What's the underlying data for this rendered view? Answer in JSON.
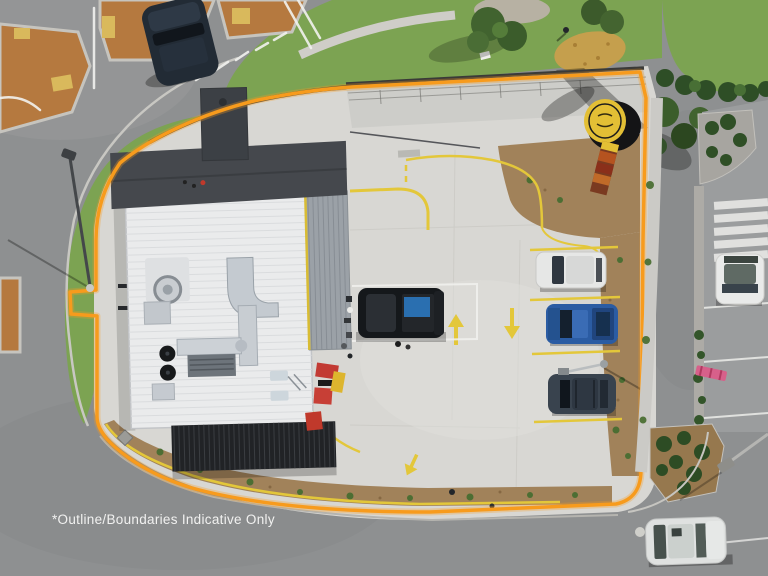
{
  "caption": {
    "text": "*Outline/Boundaries Indicative Only"
  },
  "scene": {
    "type": "aerial-drone-photo",
    "subject": "Drive-through restaurant property viewed from directly above, outlined with an indicative site boundary",
    "overlay": {
      "kind": "site-boundary-outline",
      "color": "#F79B1D",
      "note": "indicative only"
    },
    "site": {
      "building": {
        "main_roof": "white metal roof with rooftop HVAC ducts, fans and vents",
        "entry_feature": "dark charcoal awning band and tower",
        "side_wing": "grey corrugated roof with yellow trim",
        "rear_canopy": "dark slatted pergola over outdoor area",
        "outdoor_dining": "red and yellow umbrellas along east wall"
      },
      "pavement_markings": [
        "yellow drive-through lane lines",
        "yellow hatched keep-clear zones",
        "yellow directional arrows",
        "white parking bay lines",
        "blue accessible-parking square"
      ],
      "landscaping": [
        "mulched garden beds with young plants along south and east edges",
        "grass verge along west and north edges"
      ],
      "signage": {
        "pylon_sign": "round yellow disc sign with black drum edge on totem with orange menu panels"
      }
    },
    "vehicles": [
      {
        "name": "pickup-truck-at-building",
        "color": "#15181B",
        "detail": "dark ute with blue tarp load parked beside accessible bay"
      },
      {
        "name": "white-van-parking-bay",
        "color": "#E6E7E6"
      },
      {
        "name": "blue-ute-parking-bay",
        "color": "#2B5CA3"
      },
      {
        "name": "dark-suv-parking-bay",
        "color": "#39434E"
      },
      {
        "name": "dark-car-at-intersection",
        "color": "#222B35"
      },
      {
        "name": "white-car-neighbour-lot",
        "color": "#E9EAE9"
      },
      {
        "name": "white-car-street-parked",
        "color": "#DFE1E0"
      }
    ],
    "surroundings": [
      "road intersection with tan median islands and white line markings (top left)",
      "kerbed street wrapping west, south and east sides",
      "neighbouring car park with zebra crossing (top right)",
      "grass reserve with trees, gravel and straw patches (top)",
      "street light poles",
      "pedestrian on reserve"
    ]
  },
  "palette": {
    "road": "#8E9091",
    "roadLight": "#9B9D9E",
    "concrete": "#D8D7D3",
    "concreteLight": "#E0DFDB",
    "footpath": "#C9C8C3",
    "grass": "#7CA352",
    "grassDark": "#5F8A3E",
    "mulch": "#A1825A",
    "tan": "#B5793F",
    "tactile": "#D9B95C",
    "boundary": "#F79B1D",
    "marking": "#E3C73A",
    "roofWhite": "#EAEBEC",
    "roofDark": "#45484D",
    "roofGrey": "#9BA1A7",
    "canopy": "#212326",
    "signYellow": "#E3BF35",
    "signBlack": "#141416",
    "umbrellaRed": "#C23A33"
  }
}
